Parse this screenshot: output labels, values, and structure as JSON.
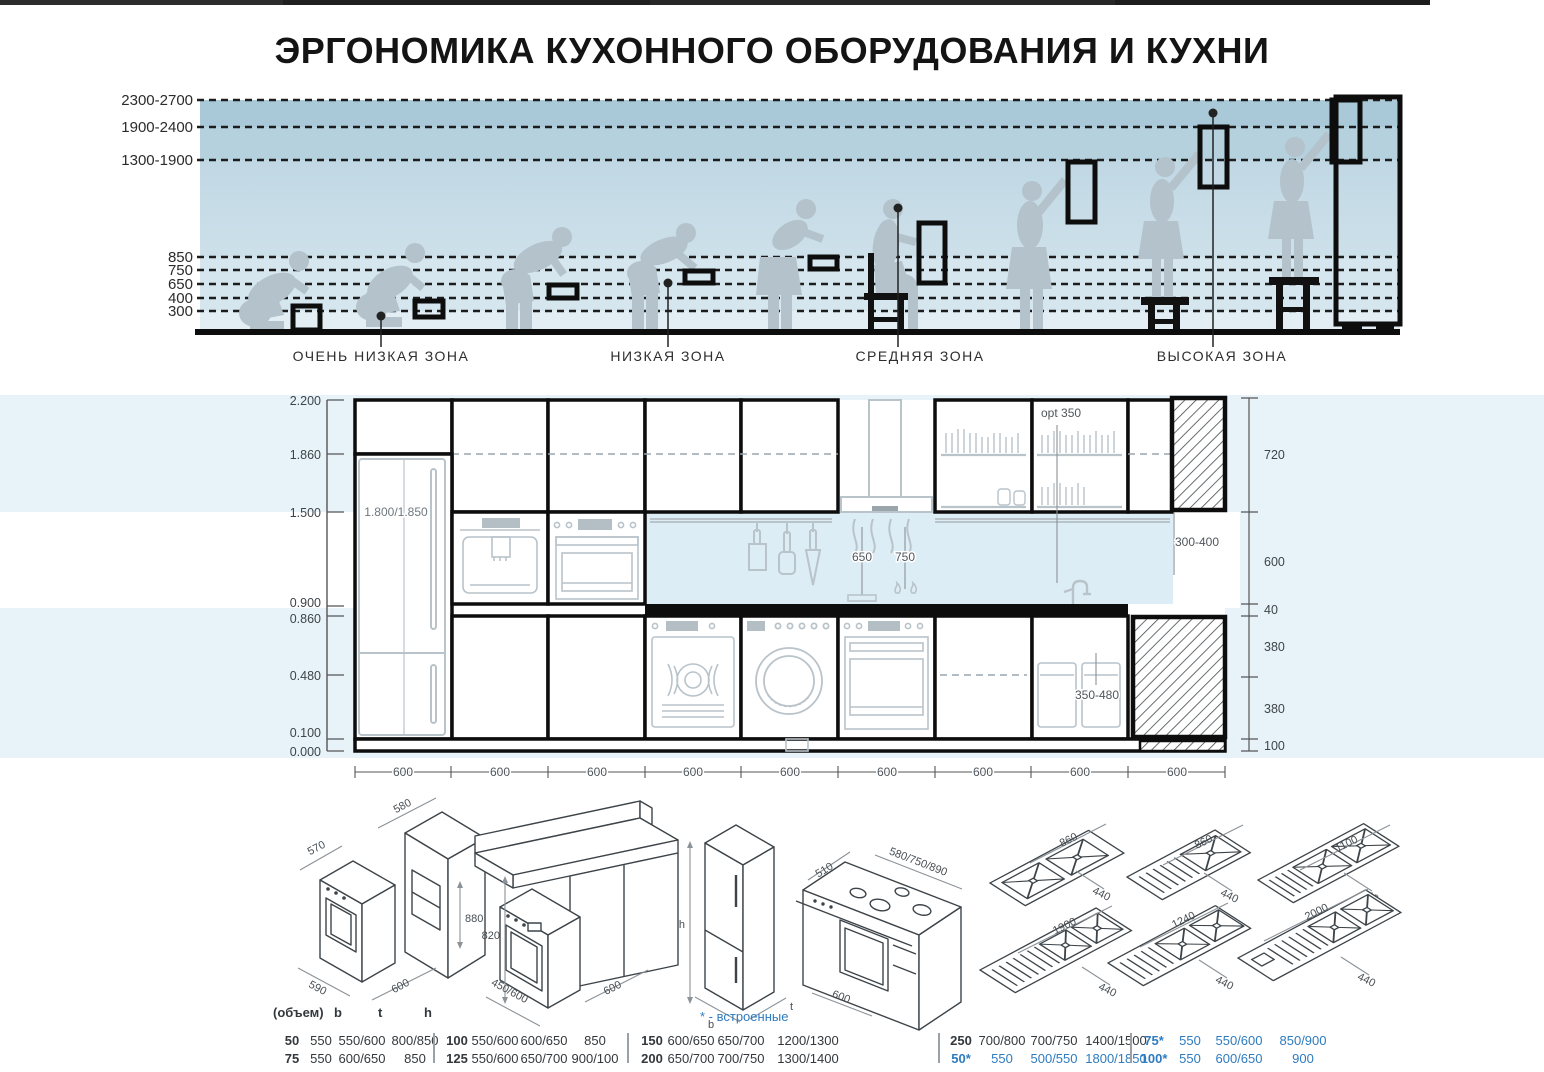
{
  "title": "ЭРГОНОМИКА КУХОННОГО ОБОРУДОВАНИЯ И КУХНИ",
  "top": {
    "heights": [
      "2300-2700",
      "1900-2400",
      "1300-1900",
      "850",
      "750",
      "650",
      "400",
      "300"
    ],
    "zones": [
      "ОЧЕНЬ НИЗКАЯ ЗОНА",
      "НИЗКАЯ ЗОНА",
      "СРЕДНЯЯ ЗОНА",
      "ВЫСОКАЯ ЗОНА"
    ]
  },
  "elev": {
    "scale": [
      "2.200",
      "1.860",
      "1.500",
      "0.900",
      "0.860",
      "0.480",
      "0.100",
      "0.000"
    ],
    "right": [
      "720",
      "600",
      "40",
      "380",
      "380",
      "100"
    ],
    "fridge": "1.800/1.850",
    "opt": "opt 350",
    "d650": "650",
    "d750": "750",
    "rail": "300-400",
    "bins": "350-480",
    "module": "600"
  },
  "iso": {
    "d1": {
      "top": "580",
      "depth": "570",
      "niche": "880",
      "front": "590",
      "side": "600"
    },
    "d2": {
      "height": "820",
      "width": "450/600",
      "side": "600"
    },
    "d3": {
      "h": "h",
      "b": "b",
      "t": "t"
    },
    "d4": {
      "depth": "510",
      "widths": "580/750/890",
      "side": "600"
    },
    "sinks": [
      [
        "860",
        "440"
      ],
      [
        "860",
        "440"
      ],
      [
        "1100",
        "440"
      ],
      [
        "1900",
        "440"
      ],
      [
        "1240",
        "440"
      ],
      [
        "2000",
        "440"
      ]
    ]
  },
  "table": {
    "vol": "(объем)",
    "b": "b",
    "t": "t",
    "h": "h",
    "note": "* - встроенные",
    "groups": [
      {
        "rows": [
          [
            "50",
            "550",
            "550/600",
            "800/850"
          ],
          [
            "75",
            "550",
            "600/650",
            "850"
          ]
        ]
      },
      {
        "rows": [
          [
            "100",
            "550/600",
            "600/650",
            "850"
          ],
          [
            "125",
            "550/600",
            "650/700",
            "900/100"
          ]
        ]
      },
      {
        "rows": [
          [
            "150",
            "600/650",
            "650/700",
            "1200/1300"
          ],
          [
            "200",
            "650/700",
            "700/750",
            "1300/1400"
          ]
        ]
      },
      {
        "rows": [
          [
            "250",
            "700/800",
            "700/750",
            "1400/1500"
          ],
          [
            "50*",
            "550",
            "500/550",
            "1800/1850"
          ]
        ]
      },
      {
        "rows": [
          [
            "75*",
            "550",
            "550/600",
            "850/900"
          ],
          [
            "100*",
            "550",
            "600/650",
            "900"
          ]
        ]
      }
    ]
  },
  "colors": {
    "accent_blue": "#2e7bbf",
    "silhouette": "#b3c2cb",
    "band_dark": "#a9c9d8",
    "band_mid": "#b6d1de",
    "band_light": "#c8dde8",
    "pale_band": "#e7f3f8",
    "backsplash": "#ddedf6",
    "linework_gray": "#b9c3ca"
  }
}
